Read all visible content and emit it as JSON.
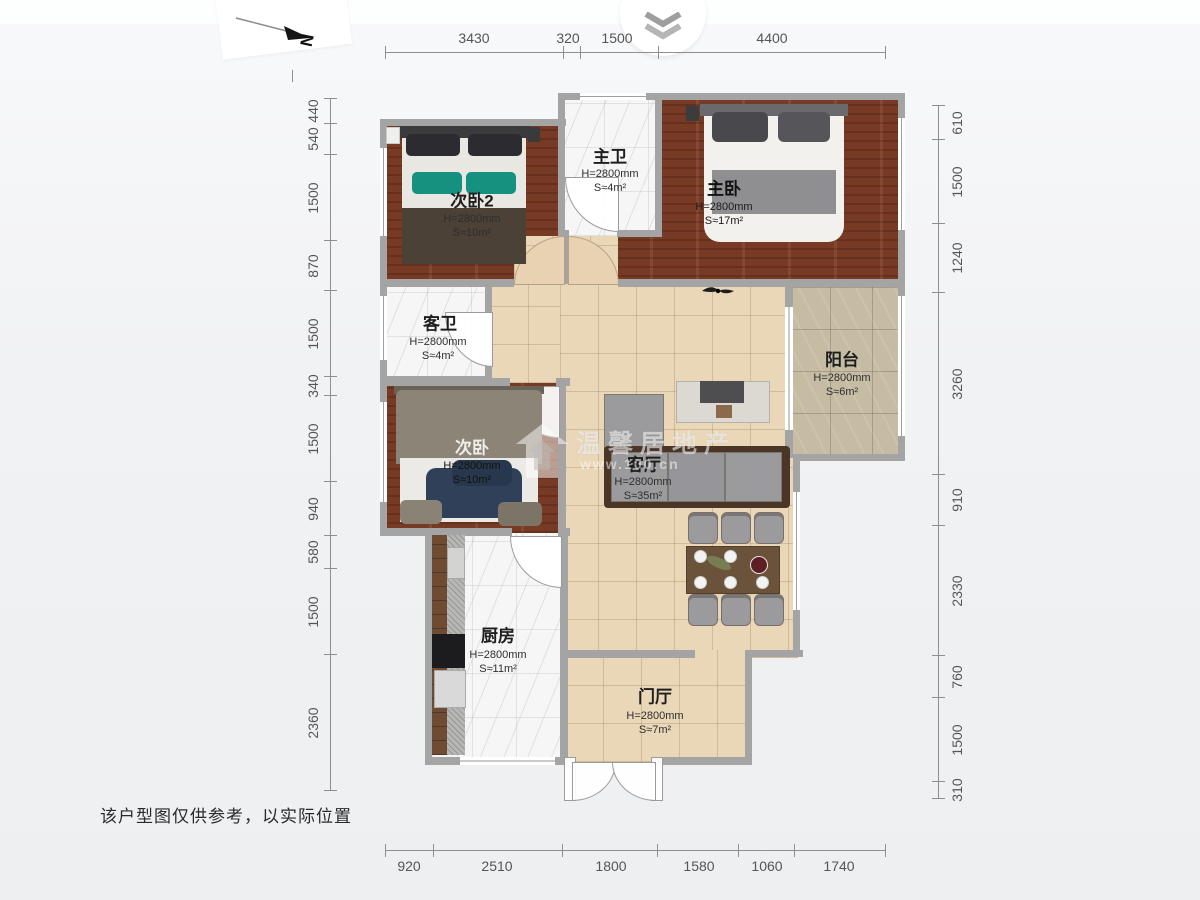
{
  "header": {
    "collapse_icon": "chevron-double-down"
  },
  "compass": {
    "north_label": "N"
  },
  "dimensions": {
    "top": [
      "3430",
      "320",
      "1500",
      "4400"
    ],
    "bottom": [
      "920",
      "2510",
      "1800",
      "1580",
      "1060",
      "1740"
    ],
    "left": [
      "440",
      "540",
      "1500",
      "870",
      "1500",
      "340",
      "1500",
      "940",
      "580",
      "1500",
      "2360"
    ],
    "right": [
      "610",
      "1500",
      "1240",
      "3260",
      "910",
      "2330",
      "760",
      "1500",
      "310"
    ]
  },
  "rooms": {
    "bedroom2": {
      "name": "次卧2",
      "height": "H=2800mm",
      "area": "S≈10m²"
    },
    "master_bath": {
      "name": "主卫",
      "height": "H=2800mm",
      "area": "S≈4m²"
    },
    "master_bedroom": {
      "name": "主卧",
      "height": "H=2800mm",
      "area": "S≈17m²"
    },
    "guest_bath": {
      "name": "客卫",
      "height": "H=2800mm",
      "area": "S≈4m²"
    },
    "bedroom3": {
      "name": "次卧",
      "height": "H=2800mm",
      "area": "S≈10m²"
    },
    "balcony": {
      "name": "阳台",
      "height": "H=2800mm",
      "area": "S≈6m²"
    },
    "living_room": {
      "name": "客厅",
      "height": "H=2800mm",
      "area": "S≈35m²"
    },
    "kitchen": {
      "name": "厨房",
      "height": "H=2800mm",
      "area": "S≈11m²"
    },
    "foyer": {
      "name": "门厅",
      "height": "H=2800mm",
      "area": "S≈7m²"
    }
  },
  "watermark": {
    "brand": "温馨居地产",
    "url": "www.100.cn"
  },
  "footer": {
    "disclaimer": "该户型图仅供参考，以实际位置"
  },
  "colors": {
    "wall": "#a4a4a4",
    "wood_floor": "#7d3d26",
    "tile_floor": "#e9d7b8",
    "accent_pillow": "#17917f"
  }
}
